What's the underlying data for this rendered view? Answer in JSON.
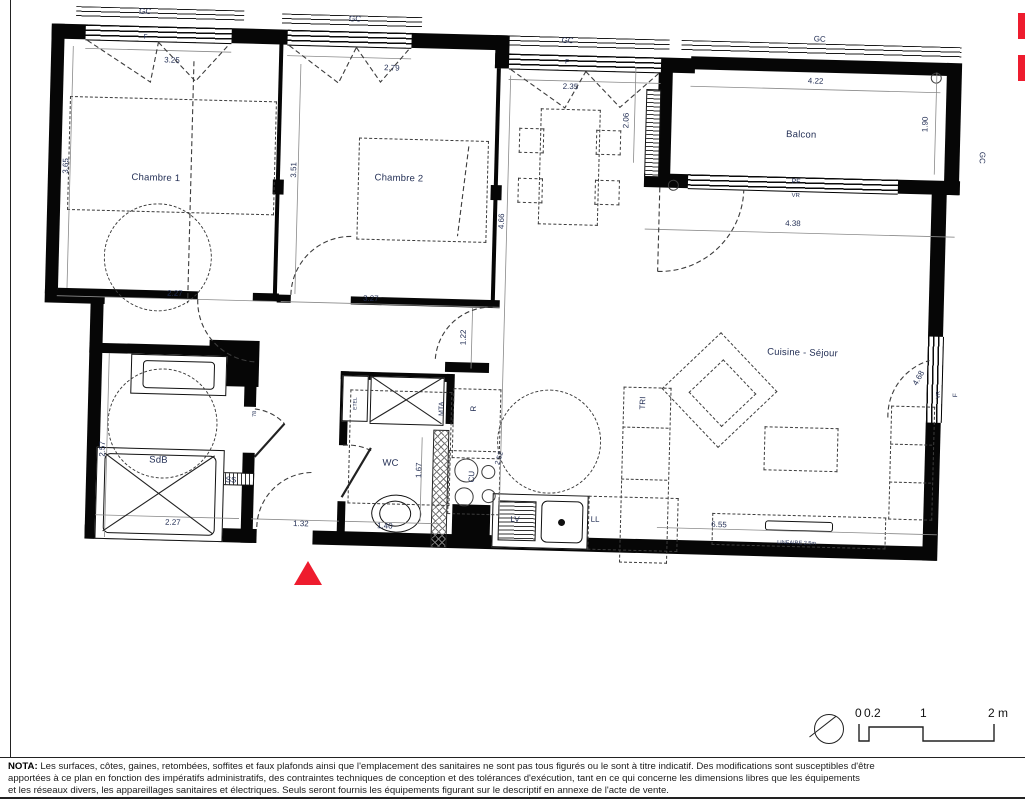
{
  "colors": {
    "accent_red": "#ee1c2e",
    "ink": "#060606",
    "label_blue": "#243056"
  },
  "plan": {
    "labels": [
      {
        "t": "GC",
        "x": 93,
        "y": 10
      },
      {
        "t": "GC",
        "x": 303,
        "y": 12
      },
      {
        "t": "GC",
        "x": 516,
        "y": 28
      },
      {
        "t": "GC",
        "x": 768,
        "y": 20
      },
      {
        "t": "GC",
        "x": 933,
        "y": 134,
        "r": 90
      },
      {
        "t": "F",
        "x": 94,
        "y": 36,
        "fs": 6.5
      },
      {
        "t": "F",
        "x": 516,
        "y": 50,
        "fs": 6.5
      },
      {
        "t": "3.25",
        "x": 121,
        "y": 58
      },
      {
        "t": "2.79",
        "x": 341,
        "y": 60
      },
      {
        "t": "2.35",
        "x": 520,
        "y": 74
      },
      {
        "t": "4.22",
        "x": 765,
        "y": 62
      },
      {
        "t": "1.90",
        "x": 876,
        "y": 102,
        "r": -90
      },
      {
        "t": "2.06",
        "x": 577,
        "y": 106,
        "r": -90
      },
      {
        "t": "Balcon",
        "x": 752,
        "y": 116,
        "fs": 9.5,
        "room": true
      },
      {
        "t": "PF",
        "x": 748,
        "y": 163,
        "fs": 7
      },
      {
        "t": "VR",
        "x": 748,
        "y": 177,
        "fs": 6
      },
      {
        "t": "4.38",
        "x": 746,
        "y": 205
      },
      {
        "t": "Chambre 1",
        "x": 108,
        "y": 176,
        "fs": 9.5,
        "room": true
      },
      {
        "t": "Chambre 2",
        "x": 351,
        "y": 170,
        "fs": 9.5,
        "room": true
      },
      {
        "t": "3.65",
        "x": 18,
        "y": 166,
        "r": -90
      },
      {
        "t": "3.51",
        "x": 246,
        "y": 164,
        "r": -90
      },
      {
        "t": "4.66",
        "x": 455,
        "y": 210,
        "r": -90
      },
      {
        "t": "2.27",
        "x": 130,
        "y": 291
      },
      {
        "t": "3.27",
        "x": 326,
        "y": 291
      },
      {
        "t": "1.22",
        "x": 420,
        "y": 327,
        "r": -90
      },
      {
        "t": "Cuisine - Séjour",
        "x": 759,
        "y": 334,
        "fs": 9.5,
        "room": true
      },
      {
        "t": "4.68",
        "x": 876,
        "y": 356,
        "r": -62
      },
      {
        "t": "VR",
        "x": 897,
        "y": 372,
        "r": -90,
        "fs": 5.5
      },
      {
        "t": "F",
        "x": 914,
        "y": 372,
        "r": -90,
        "fs": 6.5
      },
      {
        "t": "TRI",
        "x": 601,
        "y": 388,
        "r": -90
      },
      {
        "t": "R",
        "x": 432,
        "y": 398,
        "r": -90
      },
      {
        "t": "MTA",
        "x": 400,
        "y": 399,
        "r": -90,
        "fs": 7
      },
      {
        "t": "ETEL",
        "x": 314,
        "y": 396,
        "r": -90,
        "fs": 5
      },
      {
        "t": "78",
        "x": 214,
        "y": 409,
        "r": -90,
        "fs": 5.5
      },
      {
        "t": "SdB",
        "x": 118,
        "y": 458,
        "fs": 9.5,
        "room": true
      },
      {
        "t": "2.57",
        "x": 62,
        "y": 448,
        "r": -90
      },
      {
        "t": "WC",
        "x": 350,
        "y": 455,
        "fs": 9.5,
        "room": true
      },
      {
        "t": "1.67",
        "x": 379,
        "y": 461,
        "r": -90
      },
      {
        "t": "CU",
        "x": 432,
        "y": 466,
        "r": -90
      },
      {
        "t": "2.52",
        "x": 459,
        "y": 447,
        "r": -75,
        "fs": 7
      },
      {
        "t": "SS",
        "x": 191,
        "y": 476
      },
      {
        "t": "2.27",
        "x": 134,
        "y": 520
      },
      {
        "t": "1.32",
        "x": 262,
        "y": 518
      },
      {
        "t": "1.40",
        "x": 346,
        "y": 518
      },
      {
        "t": "LV",
        "x": 476,
        "y": 508
      },
      {
        "t": "LL",
        "x": 556,
        "y": 506
      },
      {
        "t": "6.55",
        "x": 680,
        "y": 508
      },
      {
        "t": "LINEAIRE 2.5m",
        "x": 758,
        "y": 525,
        "fs": 5.5
      }
    ]
  },
  "scale": {
    "t0": "0",
    "t02": "0.2",
    "t1": "1",
    "t2": "2 m"
  },
  "nota": {
    "title": "NOTA:",
    "line1": " Les surfaces, côtes, gaines, retombées, soffites et faux plafonds ainsi que l'emplacement des sanitaires ne sont pas tous figurés ou le sont à titre indicatif. Des modifications sont susceptibles d'être",
    "line2": "apportées à ce plan en fonction des impératifs administratifs, des contraintes techniques de conception et des tolérances d'exécution, tant en ce qui concerne les dimensions libres que les équipements",
    "line3": "et les réseaux divers, les appareillages sanitaires et électriques. Seuls seront fournis les équipements figurant sur le descriptif en annexe de l'acte de vente."
  }
}
